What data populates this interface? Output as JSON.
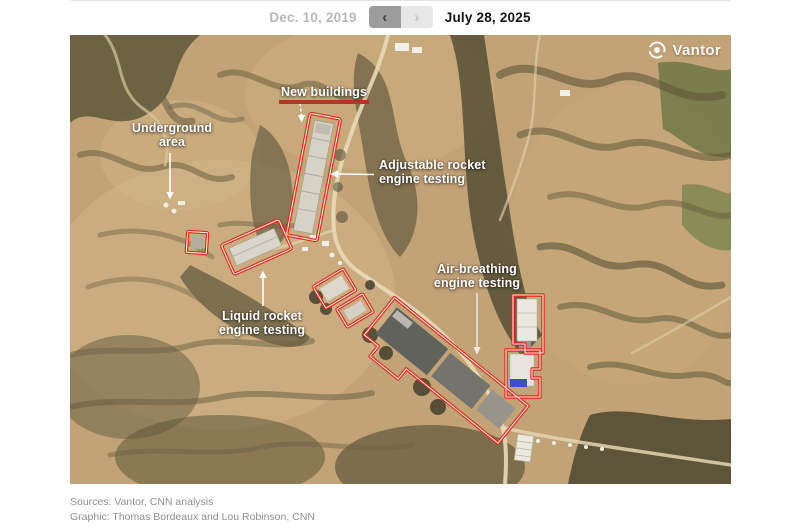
{
  "header": {
    "prev_date": "Dec. 10, 2019",
    "current_date": "July 28, 2025",
    "prev_arrow": "‹",
    "next_arrow": "›"
  },
  "map": {
    "watermark": "Vantor",
    "labels": {
      "new_buildings": {
        "line1": "New buildings"
      },
      "underground": {
        "line1": "Underground",
        "line2": "area"
      },
      "adjustable": {
        "line1": "Adjustable rocket",
        "line2": "engine testing"
      },
      "air_breathing": {
        "line1": "Air-breathing",
        "line2": "engine testing"
      },
      "liquid": {
        "line1": "Liquid rocket",
        "line2": "engine testing"
      }
    }
  },
  "colors": {
    "annotation_red": "#e22718",
    "underline_red": "#b53528",
    "terrain_tan": "#c2a277",
    "label_white": "#ffffff"
  },
  "footer": {
    "sources": "Sources: Vantor, CNN analysis",
    "graphic": "Graphic: Thomas Bordeaux and Lou Robinson, CNN"
  }
}
